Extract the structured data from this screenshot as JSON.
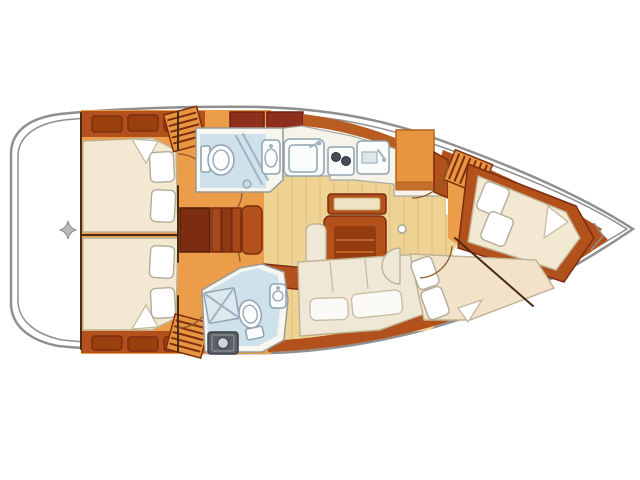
{
  "document": {
    "kind": "sailboat-interior-floor-plan-top-view",
    "orientation": {
      "bow": "right",
      "stern": "left"
    },
    "visible_text": [],
    "rooms": [
      {
        "id": "stern-deck",
        "fixtures": [
          "transom-star-marker"
        ]
      },
      {
        "id": "aft-cabin-port",
        "fixtures": [
          "double-berth",
          "two-pillows",
          "hull-lockers",
          "louvered-wardrobe",
          "door"
        ]
      },
      {
        "id": "aft-cabin-starboard",
        "fixtures": [
          "double-berth",
          "two-pillows",
          "hull-lockers",
          "louvered-wardrobe",
          "door"
        ]
      },
      {
        "id": "companionway",
        "fixtures": [
          "steps",
          "landing"
        ]
      },
      {
        "id": "heads-port",
        "fixtures": [
          "toilet",
          "washbasin",
          "shower-screen"
        ]
      },
      {
        "id": "heads-starboard",
        "fixtures": [
          "toilet",
          "washbasin",
          "shower-grate",
          "appliance-box",
          "door"
        ]
      },
      {
        "id": "galley",
        "fixtures": [
          "sink-unit",
          "two-burner-stove",
          "counter-unit",
          "chart-table",
          "storage-lockers"
        ]
      },
      {
        "id": "salon",
        "fixtures": [
          "drop-leaf-table",
          "fore-bench",
          "side-bench",
          "l-settee",
          "seat-half-round",
          "door-knob"
        ]
      },
      {
        "id": "bow-cabin-port",
        "fixtures": [
          "double-berth",
          "two-pillows",
          "louvered-wardrobe",
          "door"
        ]
      },
      {
        "id": "bow-cabin-starboard",
        "fixtures": [
          "double-berth",
          "two-pillows",
          "door"
        ]
      },
      {
        "id": "anchor-locker",
        "fixtures": []
      }
    ]
  },
  "colors": {
    "page_bg": "#ffffff",
    "hull_fill": "#ffffff",
    "hull_line": "#8f8f8f",
    "floor_orange": "#eb9d4a",
    "floor_tan": "#eed395",
    "wood": "#b2511b",
    "wood_band": "#b85c22",
    "wood_dark": "#7c2d10",
    "wood_inset": "#9a400f",
    "locker_red": "#8f2f1d",
    "berth_cream": "#f3e9d2",
    "berth_cream2": "#f2e2c9",
    "heads_blue": "#cfe2ec",
    "settee_cream": "#f0e8d6",
    "cushion_white": "#fbfaf6",
    "table_inner": "#943c0e",
    "chart_orange": "#e8953f",
    "hatch_orange": "#e8953f",
    "steps_dark": "#7c2d10",
    "appliance_gray": "#5a6066",
    "marker_gray": "#b9b9b9"
  }
}
